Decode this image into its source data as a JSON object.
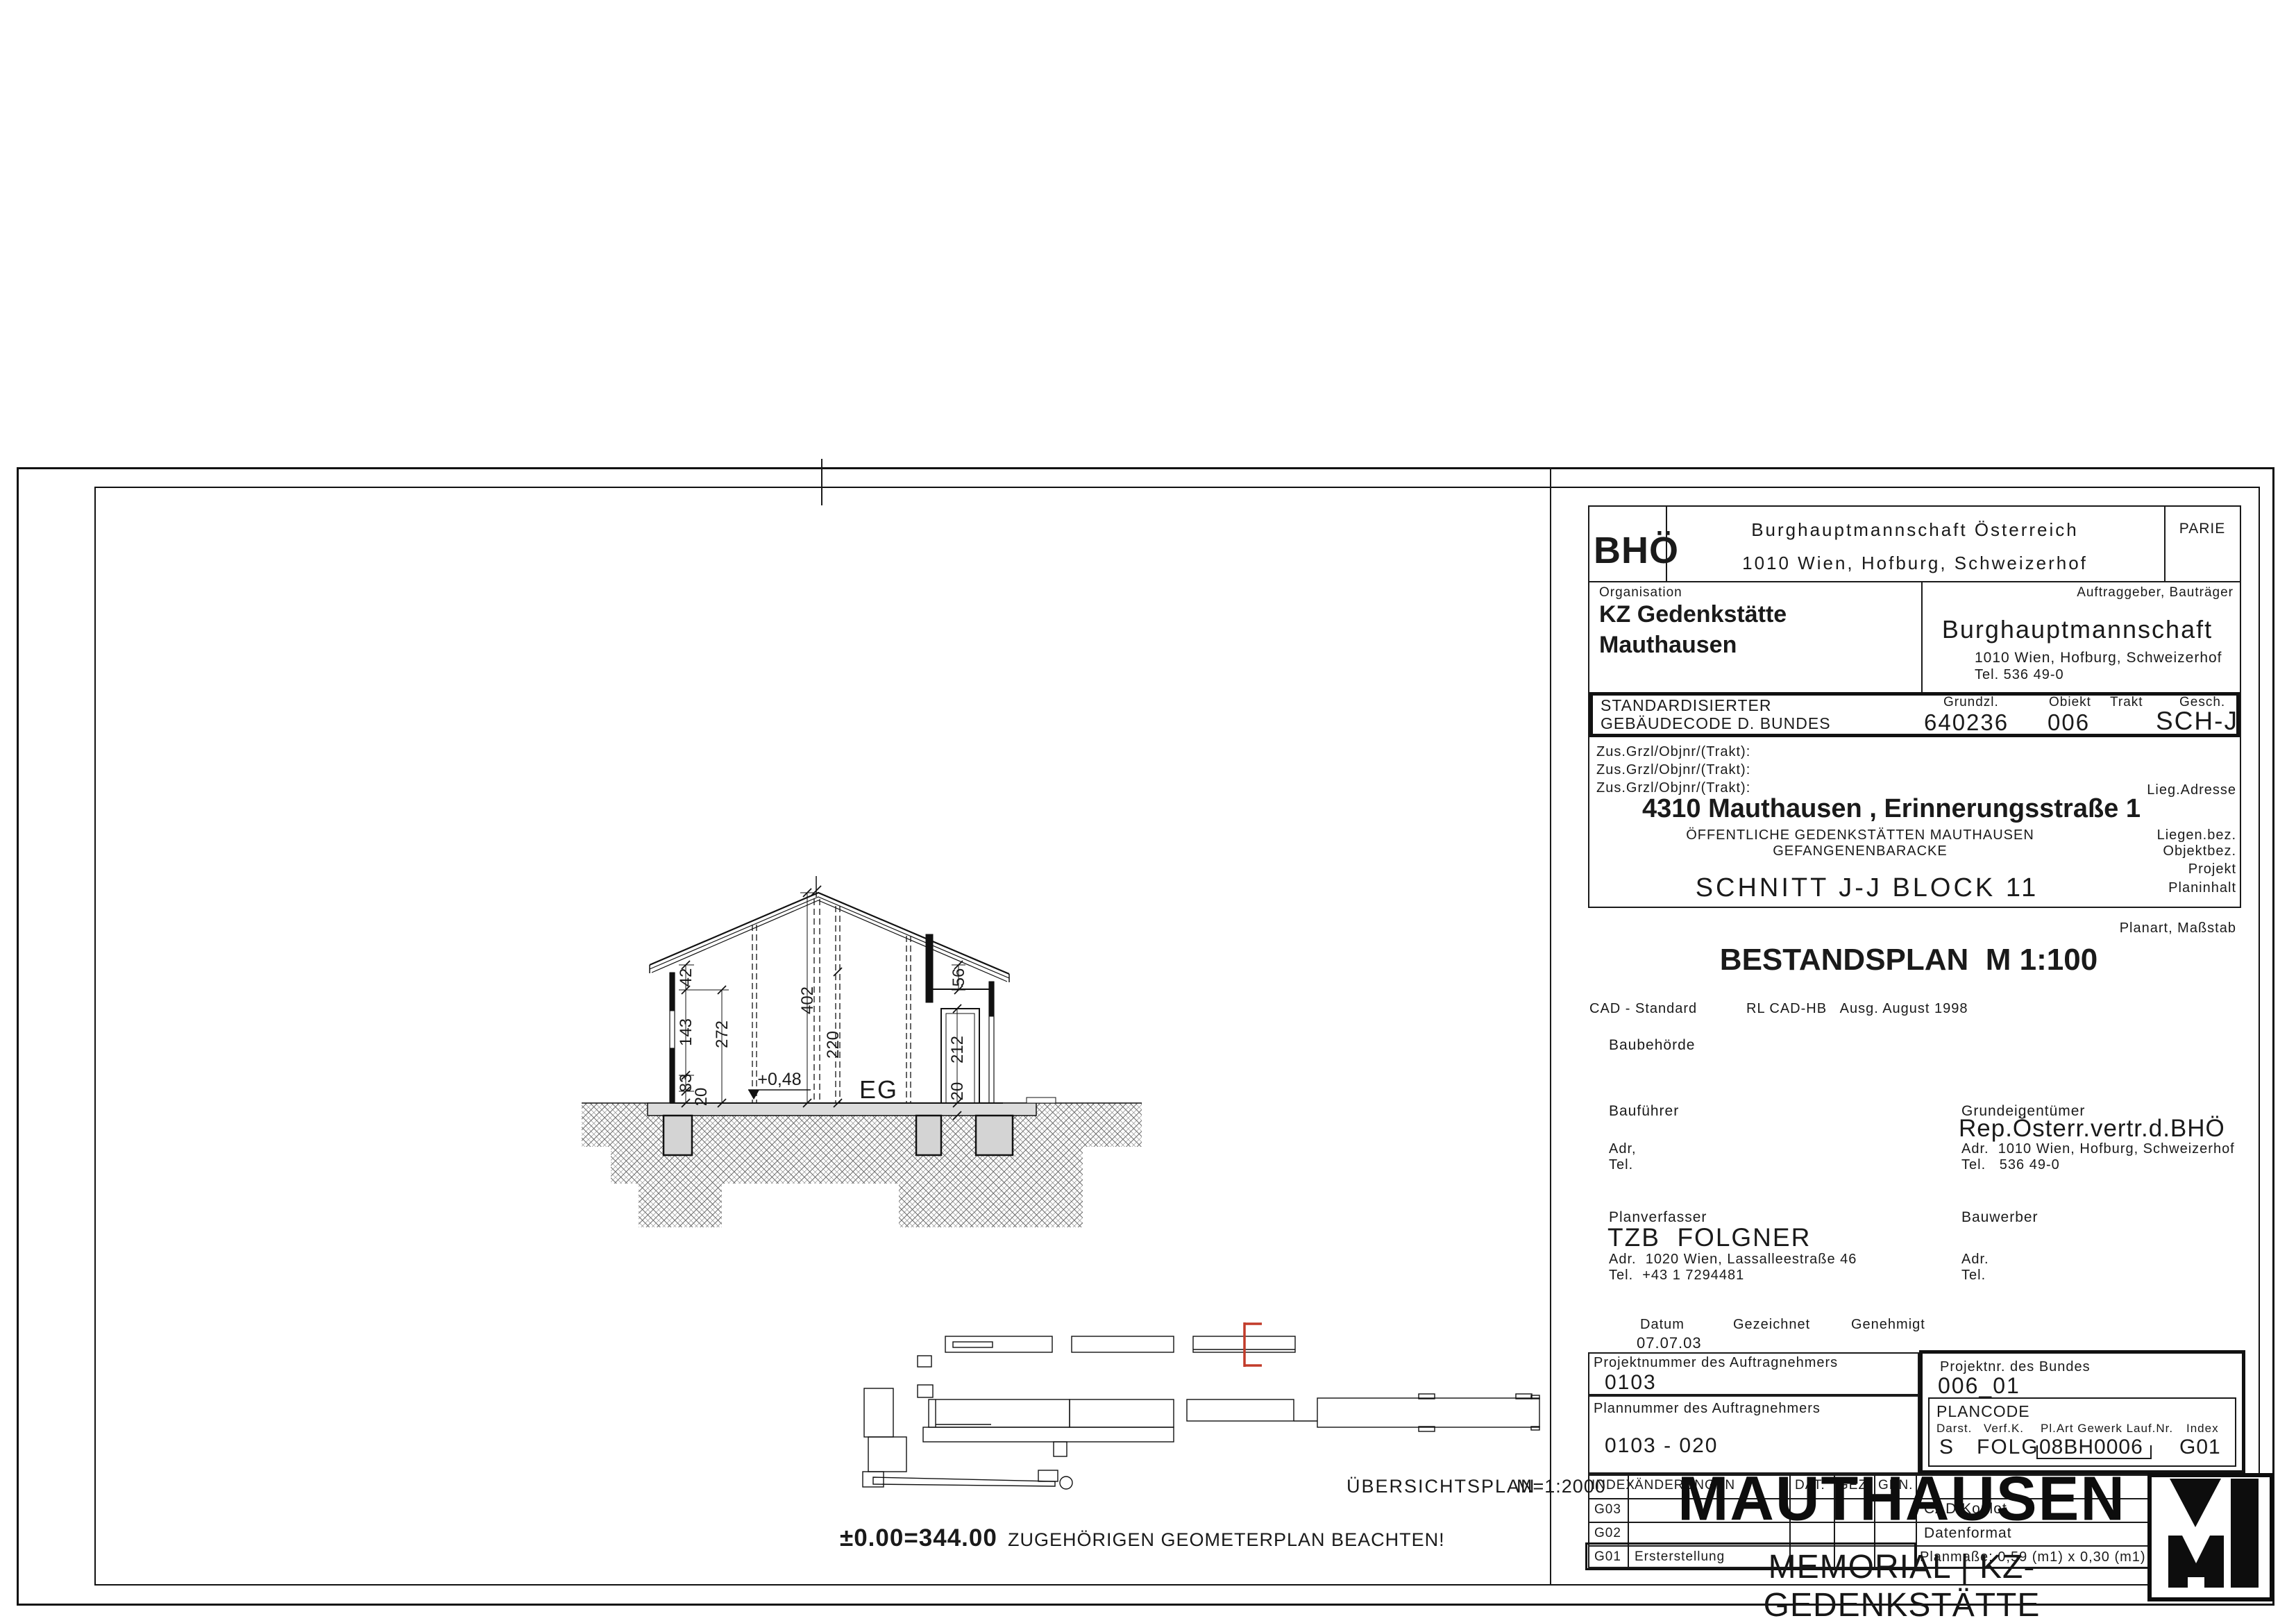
{
  "title_block": {
    "bho": "BHÖ",
    "parie": "PARIE",
    "org_line1": "Burghauptmannschaft Österreich",
    "org_line2": "1010 Wien, Hofburg, Schweizerhof",
    "organisation_label": "Organisation",
    "organisation_name1": "KZ Gedenkstätte",
    "organisation_name2": "Mauthausen",
    "client_label": "Auftraggeber, Bauträger",
    "client_name": "Burghauptmannschaft",
    "client_addr": "1010 Wien, Hofburg, Schweizerhof",
    "client_tel": "Tel. 536 49-0",
    "code_label1": "STANDARDISIERTER",
    "code_label2": "GEBÄUDECODE D. BUNDES",
    "grundzl_label": "Grundzl.",
    "grundzl_value": "640236",
    "objekt_label": "Obiekt",
    "objekt_value": "006",
    "trakt_label": "Trakt",
    "gesch_label": "Gesch.",
    "gesch_value": "SCH-J",
    "zus": [
      "Zus.Grzl/Objnr/(Trakt):",
      "Zus.Grzl/Objnr/(Trakt):",
      "Zus.Grzl/Objnr/(Trakt):"
    ],
    "lieg_adresse_label": "Lieg.Adresse",
    "address": "4310 Mauthausen , Erinnerungsstraße 1",
    "liegen_bez": "ÖFFENTLICHE GEDENKSTÄTTEN MAUTHAUSEN",
    "objekt_bez": "GEFANGENENBARACKE",
    "liegen_bez_label": "Liegen.bez.",
    "objekt_bez_label": "Objektbez.",
    "projekt_label": "Projekt",
    "planinhalt": "SCHNITT J-J    BLOCK 11",
    "planinhalt_label": "Planinhalt",
    "planart_label": "Planart, Maßstab",
    "planart": "BESTANDSPLAN  M 1:100",
    "cad_standard": "CAD - Standard",
    "cad_rl": "RL CAD-HB   Ausg. August 1998",
    "baubehoerde_label": "Baubehörde",
    "baufuehrer_label": "Bauführer",
    "baufuehrer_adr": "Adr,",
    "baufuehrer_tel": "Tel.",
    "grundeig_label": "Grundeigentümer",
    "grundeig_name": "Rep.Österr.vertr.d.BHÖ",
    "grundeig_adr": "Adr.  1010 Wien, Hofburg, Schweizerhof",
    "grundeig_tel": "Tel.   536 49-0",
    "planverfasser_label": "Planverfasser",
    "planverfasser_name": "TZB  FOLGNER",
    "planverfasser_adr": "Adr.  1020 Wien, Lassalleestraße 46",
    "planverfasser_tel": "Tel.  +43 1 7294481",
    "bauwerber_label": "Bauwerber",
    "bauwerber_adr": "Adr.",
    "bauwerber_tel": "Tel.",
    "datum_label": "Datum",
    "datum_value": "07.07.03",
    "gezeichnet_label": "Gezeichnet",
    "genehmigt_label": "Genehmigt",
    "projektnr_an_label": "Projektnummer des Auftragnehmers",
    "projektnr_an": "0103",
    "plannr_an_label": "Plannummer des Auftragnehmers",
    "plannr_an": "0103 - 020",
    "projektnr_bund_label": "Projektnr. des Bundes",
    "projektnr_bund": "006_01",
    "plancode_label": "PLANCODE",
    "plancode_cols": [
      "Darst.",
      "Verf.K.",
      "Pl.Art Gewerk Lauf.Nr.",
      "Index"
    ],
    "plancode_vals": [
      "S",
      "FOLG",
      "08BH0006",
      "G01"
    ]
  },
  "index_table": {
    "headers": [
      "INDEX",
      "ÄNDERUNGEN",
      "DAT.",
      "GEZ.",
      "GEN."
    ],
    "rows": [
      {
        "index": "G03",
        "text": ""
      },
      {
        "index": "G02",
        "text": ""
      },
      {
        "index": "G01",
        "text": "Ersterstellung"
      }
    ],
    "info": [
      {
        "label": "CAD/Koplot",
        "value": "ACAD14_N"
      },
      {
        "label": "Datenformat",
        "value": "DWG"
      },
      {
        "label": "Planmaße: 0,59 (m1) x 0,30 (m1) =",
        "value": "(m2)"
      }
    ]
  },
  "logo": {
    "name": "MAUTHAUSEN",
    "sub": "MEMORIAL | KZ-GEDENKSTÄTTE"
  },
  "section": {
    "d42": "42",
    "d143": "143",
    "d83": "83",
    "d20l": "20",
    "d272": "272",
    "d402": "402",
    "d220": "220",
    "level": "+0,48",
    "eg": "EG",
    "d56": "56",
    "d212": "212",
    "d20r": "20"
  },
  "site_plan": {
    "title": "ÜBERSICHTSPLAN",
    "scale": "M=1:2000",
    "level": "±0.00=344.00",
    "note": "ZUGEHÖRIGEN GEOMETERPLAN BEACHTEN!"
  },
  "colors": {
    "ink": "#1a1a1a",
    "section_mark_red": "#c23b2a",
    "slab_grey": "#dcdcdc"
  }
}
